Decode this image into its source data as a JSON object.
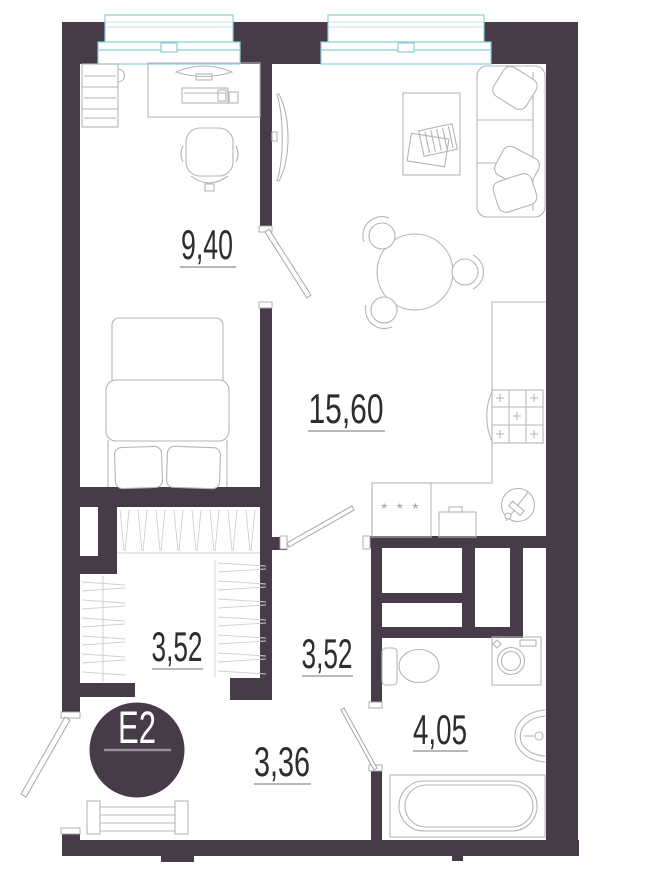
{
  "plan": {
    "unit": {
      "label": "E2"
    },
    "rooms": {
      "bedroom": {
        "area": "9,40"
      },
      "living_kitchen": {
        "area": "15,60"
      },
      "wardrobe": {
        "area": "3,52"
      },
      "corridor": {
        "area": "3,52"
      },
      "hallway": {
        "area": "3,36"
      },
      "bathroom": {
        "area": "4,05"
      }
    },
    "symbols": {
      "fridge": "* * *"
    }
  },
  "colors": {
    "wall": "#473a49",
    "window": "#8ad0d5",
    "window_light": "#c2e8ea",
    "furniture": "#b6b4b8",
    "door": "#a8a6aa",
    "label": "#2e2c2f",
    "underline": "#8e8c90",
    "badge_text": "#ffffff",
    "badge_line": "#9a8d9e",
    "background": "#ffffff"
  }
}
